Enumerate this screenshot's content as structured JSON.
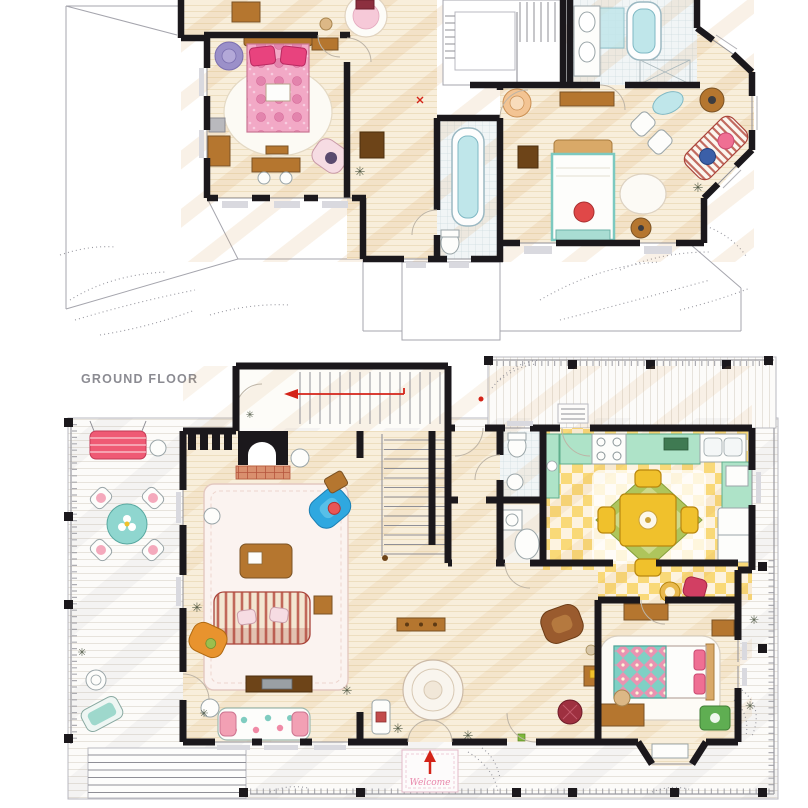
{
  "poster": {
    "ground_floor_label": "GROUND FLOOR",
    "welcome_mat_text": "Welcome"
  },
  "icons": {
    "plant": "✳"
  },
  "palette": {
    "paper": "#ffffff",
    "wall": "#1b181c",
    "line": "#a5a5ad",
    "label-gray": "#8b8b92",
    "marker-red": "#d42318",
    "wood-floor": "#f8eedb",
    "wood-line": "#ead8b6",
    "plank": "#fcfbf9",
    "tile-line": "#cfdce0",
    "checker-yellow": "#f8d873",
    "counter-teal": "#aee3c8",
    "counter-edge": "#5fae8b",
    "aqua": "#bfe6ea",
    "hot-pink": "#e8437e",
    "rose": "#f2a9c6",
    "purple": "#9b90c9",
    "bright-blue": "#2fa8e0",
    "maroon": "#a8433a",
    "swing-red": "#ef5a74",
    "orange": "#e8932e",
    "wood": "#b5762f",
    "dark-wood": "#6d4418",
    "leather": "#9a5b2e",
    "brick": "#d98f6e",
    "lawn-green": "#5fae52",
    "olive": "#aac355",
    "teal": "#8fd6cf",
    "crimson": "#d23f63",
    "quilt-teal": "#7fd0c4",
    "quilt-pink": "#ef8fb0",
    "table-yellow": "#f0c12c",
    "blush": "#f6dce3"
  }
}
